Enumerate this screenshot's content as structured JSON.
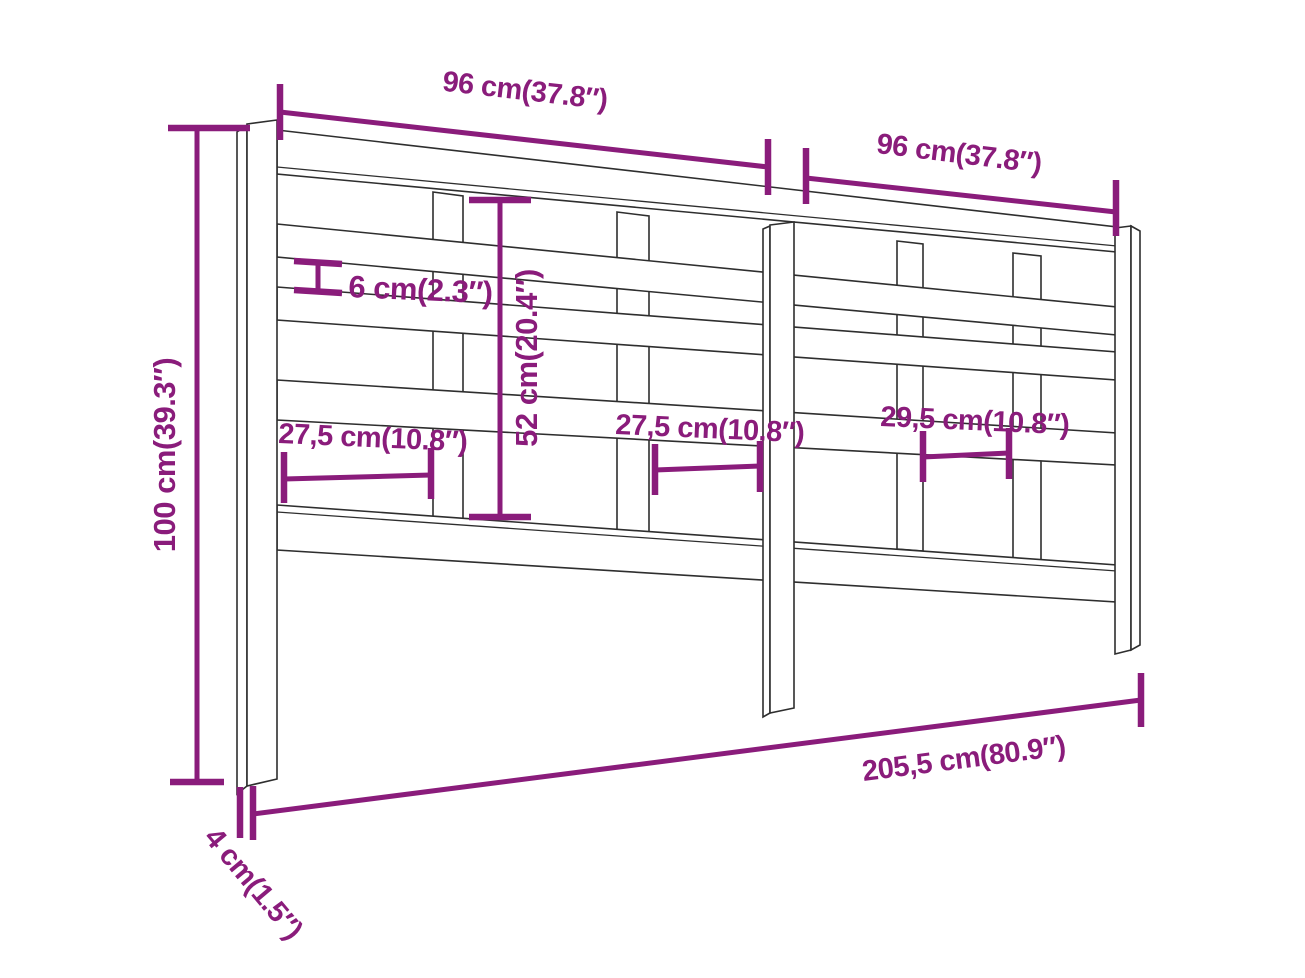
{
  "diagram": {
    "subject": "headboard-dimension-drawing",
    "accent_color": "#8a1c7b",
    "line_color": "#2e2e2e",
    "background_color": "#ffffff",
    "dimensions": {
      "top_left_width": "96 cm(37.8″)",
      "top_right_width": "96 cm(37.8″)",
      "rail_gap": "6 cm(2.3″)",
      "inner_height": "52 cm(20.4″)",
      "total_height": "100 cm(39.3″)",
      "panel_left_width": "27,5 cm(10.8″)",
      "panel_middle_width": "27,5 cm(10.8″)",
      "panel_right_width": "29,5 cm(10.8″)",
      "total_width": "205,5 cm(80.9″)",
      "post_depth": "4 cm(1.5″)"
    }
  }
}
